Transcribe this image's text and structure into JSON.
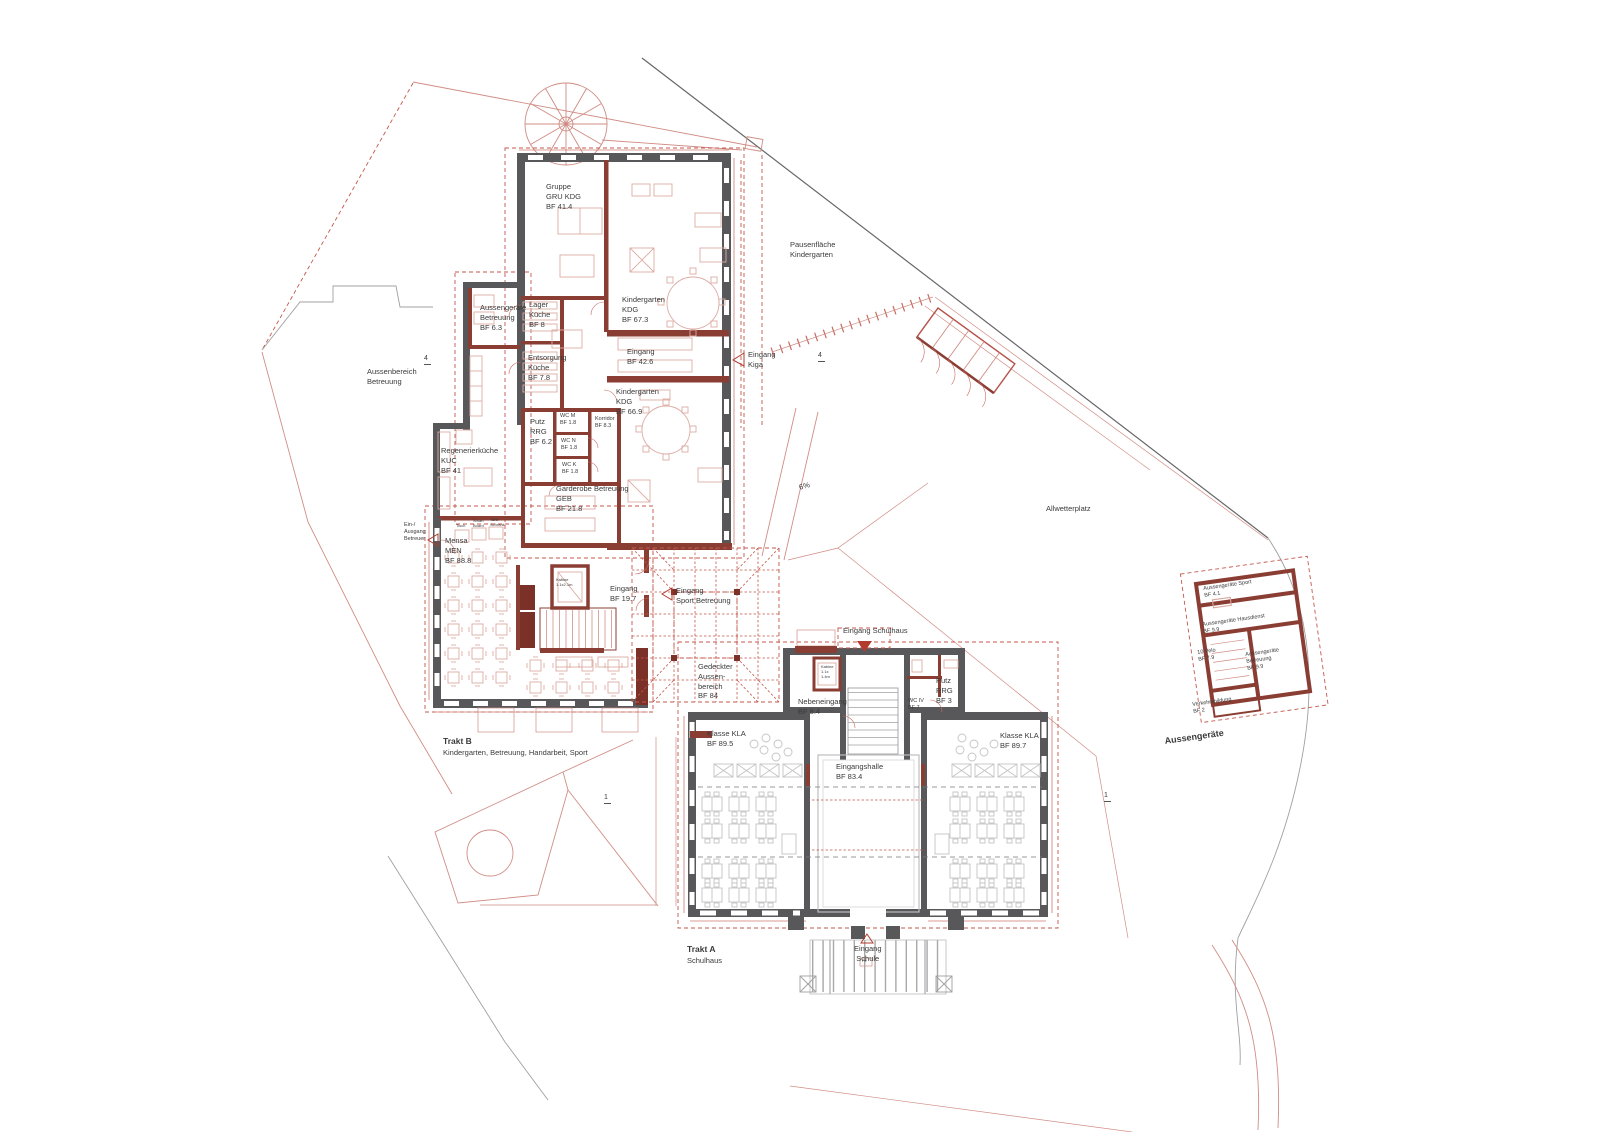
{
  "colors": {
    "wall_existing": "#58585b",
    "wall_new": "#8a3d33",
    "wall_dark_red": "#7c3128",
    "accent_red": "#b23b2e",
    "line_light_red": "#d18d85",
    "dashed_red": "#c4574b",
    "furniture_pink": "#dcaca4",
    "furniture_gray": "#c4c4c6",
    "site_gray": "#a0a0a2",
    "site_dark": "#66666a",
    "text": "#3a3a3a"
  },
  "site": {
    "pausenflaeche": "Pausenfläche\nKindergarten",
    "aussenbereich": "Aussenbereich\nBetreuung",
    "allwetterplatz": "Allwetterplatz",
    "slope": "6%",
    "marker4_left": "4",
    "marker4_right": "4",
    "marker1_left": "1",
    "marker1_right": "1"
  },
  "trakt_b": {
    "title": "Trakt B",
    "subtitle": "Kindergarten, Betreuung, Handarbeit, Sport",
    "rooms": {
      "gruppe": "Gruppe\nGRU KDG\nBF 41.4",
      "kdg1": "Kindergarten\nKDG\nBF 67.3",
      "eingang_kdg": "Eingang\nBF 42.6",
      "kdg2": "Kindergarten\nKDG\nBF 66.9",
      "lager": "Lager\nKüche\nBF 8",
      "entsorgung": "Entsorgung\nKüche\nBF 7.8",
      "aussengeraete_betreuung": "Aussengeräte\nBetreuung\nBF 6.3",
      "putz": "Putz\nRRG\nBF 6.2",
      "wc_m": "WC M\nBF 1.8",
      "wc_n": "WC N\nBF 1.8",
      "wc_k": "WC K\nBF 1.8",
      "korridor": "Korridor\nBF 8.3",
      "regenerierkueche": "Regenerierküche\nKUC\nBF 41",
      "garderobe": "Garderobe Betreuung\nGEB\nBF 21.8",
      "mensa": "Mensa\nMEN\nBF 88.8",
      "tisch": "Tisch",
      "smartboard": "Smart\nBoard",
      "tafelschrank": "Tafel-\nSchrank",
      "ein_ausgang": "Ein-/\nAusgang\nBetreuer",
      "kabine": "Kabine\n1.1x2.1m",
      "eingang_b": "Eingang\nBF 19.7",
      "eingang_sport": "Eingang\nSport Betreuung",
      "gedeckter": "Gedeckter\nAussen-\nbereich\nBF 84",
      "eingang_kiga": "Eingang\nKiga"
    }
  },
  "trakt_a": {
    "title": "Trakt A",
    "subtitle": "Schulhaus",
    "rooms": {
      "eingang_schulhaus": "Eingang Schulhaus",
      "nebeneingang": "Nebeneingang\nBF 8.4",
      "kabine": "Kabine\n1.1x\n1.4m",
      "putz": "Putz\nRRG\nBF 3",
      "wc_iv": "WC IV\nBF 7",
      "klasse_links": "Klasse KLA\nBF 89.5",
      "klasse_rechts": "Klasse KLA\nBF 89.7",
      "eingangshalle": "Eingangshalle\nBF 83.4",
      "eingang_schule": "Eingang\nSchule",
      "fe": "Fe"
    }
  },
  "aussengeraete": {
    "title": "Aussengeräte",
    "rooms": {
      "sport": "Aussengeräte Sport\nBF 4.1",
      "hausdienst": "Aussengeräte Hausdienst\nBF 9.9",
      "velo": "10 Velo\nBF 7.9",
      "betreuung": "Aussengeräte\nBetreuung\nBF 9.9",
      "verkehrsbildung": "Verkehrsbildung\nBF 2"
    }
  }
}
